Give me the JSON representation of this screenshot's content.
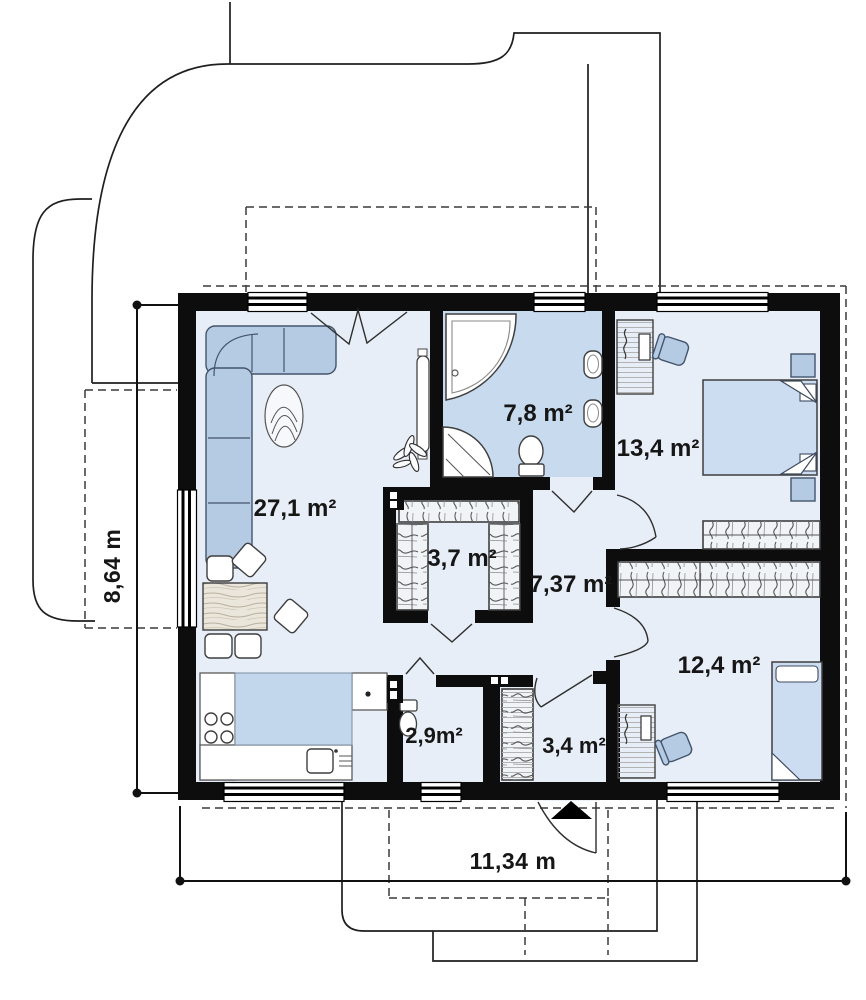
{
  "plan": {
    "type": "house-floor-plan",
    "rooms": [
      {
        "id": "living-room",
        "area_label": "27,1 m²"
      },
      {
        "id": "bathroom",
        "area_label": "7,8 m²"
      },
      {
        "id": "bedroom-1",
        "area_label": "13,4 m²"
      },
      {
        "id": "wardrobe",
        "area_label": "3,7 m²"
      },
      {
        "id": "hallway",
        "area_label": "7,37 m²"
      },
      {
        "id": "bedroom-2",
        "area_label": "12,4 m²"
      },
      {
        "id": "wc",
        "area_label": "2,9m²"
      },
      {
        "id": "entrance-hall",
        "area_label": "3,4 m²"
      }
    ],
    "dimensions": {
      "overall_width_label": "11,34 m",
      "overall_height_label": "8,64 m"
    },
    "colors": {
      "wall": "#0d0d0d",
      "floor": "#e8eef7",
      "bathroom_floor": "#c7daee",
      "kitchen_counter": "#c3d7ec",
      "furniture_blue": "#b5cbe4",
      "bed_blue": "#ccddf1"
    }
  }
}
